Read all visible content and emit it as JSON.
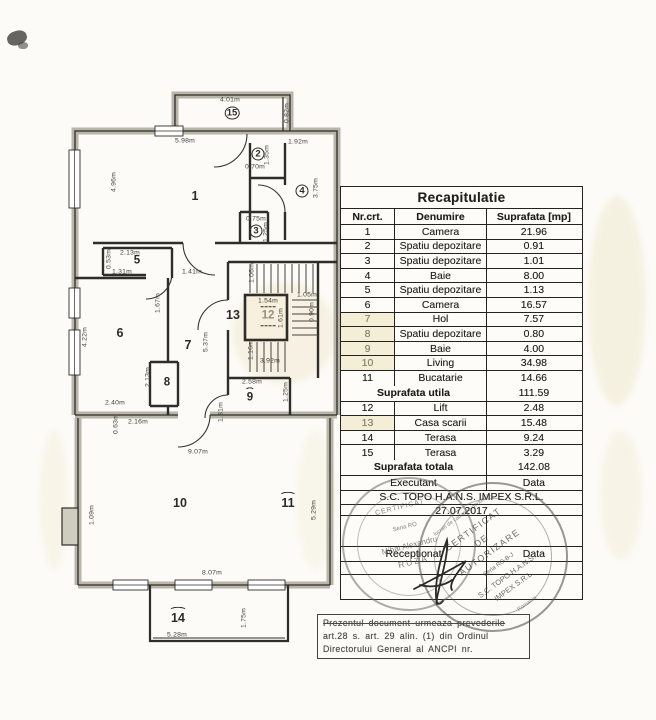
{
  "table": {
    "title": "Recapitulatie",
    "col_nr": "Nr.crt.",
    "col_den": "Denumire",
    "col_sup": "Suprafata [mp]",
    "rows1": [
      {
        "nr": "1",
        "name": "Camera",
        "area": "21.96"
      },
      {
        "nr": "2",
        "name": "Spatiu depozitare",
        "area": "0.91"
      },
      {
        "nr": "3",
        "name": "Spatiu depozitare",
        "area": "1.01"
      },
      {
        "nr": "4",
        "name": "Baie",
        "area": "8.00"
      },
      {
        "nr": "5",
        "name": "Spatiu depozitare",
        "area": "1.13"
      },
      {
        "nr": "6",
        "name": "Camera",
        "area": "16.57"
      },
      {
        "nr": "7",
        "name": "Hol",
        "area": "7.57",
        "f": 1
      },
      {
        "nr": "8",
        "name": "Spatiu depozitare",
        "area": "0.80",
        "f": 1
      },
      {
        "nr": "9",
        "name": "Baie",
        "area": "4.00",
        "f": 1
      },
      {
        "nr": "10",
        "name": "Living",
        "area": "34.98",
        "f": 1
      },
      {
        "nr": "11",
        "name": "Bucatarie",
        "area": "14.66"
      }
    ],
    "subtotal": {
      "label": "Suprafata utila",
      "value": "111.59"
    },
    "rows2": [
      {
        "nr": "12",
        "name": "Lift",
        "area": "2.48"
      },
      {
        "nr": "13",
        "name": "Casa scarii",
        "area": "15.48",
        "f": 1
      },
      {
        "nr": "14",
        "name": "Terasa",
        "area": "9.24"
      },
      {
        "nr": "15",
        "name": "Terasa",
        "area": "3.29"
      }
    ],
    "total": {
      "label": "Suprafata totala",
      "value": "142.08"
    },
    "executant_label": "Executant",
    "executant_data_label": "Data",
    "company": "S.C. TOPO H.A.N.S. IMPEX S.R.L.",
    "date": "27.07.2017",
    "receptionat_label": "Receptionat",
    "receptionat_data_label": "Data"
  },
  "note": {
    "lines": [
      "Prezentul document urmeaza prevederile",
      "art.28 s. art. 29 alin. (1) din Ordinul",
      "Directorului General al ANCPI nr."
    ]
  },
  "stamp_left": {
    "lines": [
      "CERTIFICAT",
      "Seria RO",
      "Mihai Alexandru",
      "RUZA"
    ]
  },
  "stamp_right": {
    "arc_top": "lucrari de cadastru geodezie",
    "lines": [
      "CERTIFICAT",
      "DE",
      "AUTORIZARE",
      "Seria RO-B-J",
      "S.C. TOPO H.A.N.S.",
      "IMPEX S.R.L."
    ],
    "bottom": "Romania"
  },
  "floorplan": {
    "room_numbers": [
      {
        "n": "15",
        "x": 232,
        "y": 113,
        "s": "circle"
      },
      {
        "n": "1",
        "x": 195,
        "y": 196,
        "s": "big"
      },
      {
        "n": "2",
        "x": 258,
        "y": 154,
        "s": "circle"
      },
      {
        "n": "4",
        "x": 302,
        "y": 191,
        "s": "circle"
      },
      {
        "n": "3",
        "x": 256,
        "y": 231,
        "s": "circle"
      },
      {
        "n": "5",
        "x": 137,
        "y": 261,
        "s": "plain"
      },
      {
        "n": "6",
        "x": 120,
        "y": 333,
        "s": "big"
      },
      {
        "n": "7",
        "x": 188,
        "y": 345,
        "s": "big"
      },
      {
        "n": "13",
        "x": 233,
        "y": 315,
        "s": "big"
      },
      {
        "n": "12",
        "x": 268,
        "y": 316,
        "s": "dash faded"
      },
      {
        "n": "8",
        "x": 167,
        "y": 383,
        "s": "plain"
      },
      {
        "n": "9",
        "x": 250,
        "y": 398,
        "s": "hat"
      },
      {
        "n": "10",
        "x": 180,
        "y": 503,
        "s": "big"
      },
      {
        "n": "11",
        "x": 288,
        "y": 503,
        "s": "big hat"
      },
      {
        "n": "14",
        "x": 178,
        "y": 618,
        "s": "big hat"
      }
    ],
    "dimensions": [
      {
        "t": "4.01m",
        "x": 230,
        "y": 100
      },
      {
        "t": "0.82m",
        "x": 287,
        "y": 113,
        "r": 1
      },
      {
        "t": "5.98m",
        "x": 185,
        "y": 141
      },
      {
        "t": "1.92m",
        "x": 298,
        "y": 142
      },
      {
        "t": "4.96m",
        "x": 114,
        "y": 182,
        "r": 1
      },
      {
        "t": "1.35m",
        "x": 267,
        "y": 155,
        "r": 1
      },
      {
        "t": "0.70m",
        "x": 255,
        "y": 167
      },
      {
        "t": "3.75m",
        "x": 316,
        "y": 188,
        "r": 1
      },
      {
        "t": "0.75m",
        "x": 256,
        "y": 219
      },
      {
        "t": "1.25m",
        "x": 266,
        "y": 232,
        "r": 1
      },
      {
        "t": "2.13m",
        "x": 130,
        "y": 253
      },
      {
        "t": "0.53m",
        "x": 109,
        "y": 259,
        "r": 1
      },
      {
        "t": "1.31m",
        "x": 122,
        "y": 272
      },
      {
        "t": "1.41m",
        "x": 192,
        "y": 272
      },
      {
        "t": "1.06m",
        "x": 252,
        "y": 273,
        "r": 1
      },
      {
        "t": "1.54m",
        "x": 268,
        "y": 301
      },
      {
        "t": "1.05m",
        "x": 307,
        "y": 295
      },
      {
        "t": "1.67m",
        "x": 158,
        "y": 303,
        "r": 1
      },
      {
        "t": "1.61m",
        "x": 281,
        "y": 318,
        "r": 1
      },
      {
        "t": "0.90m",
        "x": 312,
        "y": 312,
        "r": 1
      },
      {
        "t": "4.22m",
        "x": 85,
        "y": 337,
        "r": 1
      },
      {
        "t": "5.37m",
        "x": 206,
        "y": 342,
        "r": 1
      },
      {
        "t": "1.16m",
        "x": 251,
        "y": 350,
        "r": 1
      },
      {
        "t": "3.92m",
        "x": 270,
        "y": 361
      },
      {
        "t": "2.13m",
        "x": 148,
        "y": 377,
        "r": 1
      },
      {
        "t": "2.58m",
        "x": 252,
        "y": 382
      },
      {
        "t": "1.25m",
        "x": 286,
        "y": 392,
        "r": 1
      },
      {
        "t": "2.40m",
        "x": 115,
        "y": 403
      },
      {
        "t": "1.81m",
        "x": 221,
        "y": 412,
        "r": 1
      },
      {
        "t": "2.16m",
        "x": 138,
        "y": 422
      },
      {
        "t": "0.63m",
        "x": 116,
        "y": 424,
        "r": 1
      },
      {
        "t": "9.07m",
        "x": 198,
        "y": 452
      },
      {
        "t": "1.09m",
        "x": 92,
        "y": 515,
        "r": 1
      },
      {
        "t": "5.29m",
        "x": 314,
        "y": 510,
        "r": 1
      },
      {
        "t": "8.07m",
        "x": 212,
        "y": 573
      },
      {
        "t": "1.75m",
        "x": 244,
        "y": 618,
        "r": 1
      },
      {
        "t": "5.28m",
        "x": 177,
        "y": 635
      }
    ]
  },
  "colors": {
    "ink": "#23231f",
    "wall_gray": "#b9b5a8",
    "highlight_cream": "#f5eed6",
    "stamp_gray": "#74736c"
  }
}
